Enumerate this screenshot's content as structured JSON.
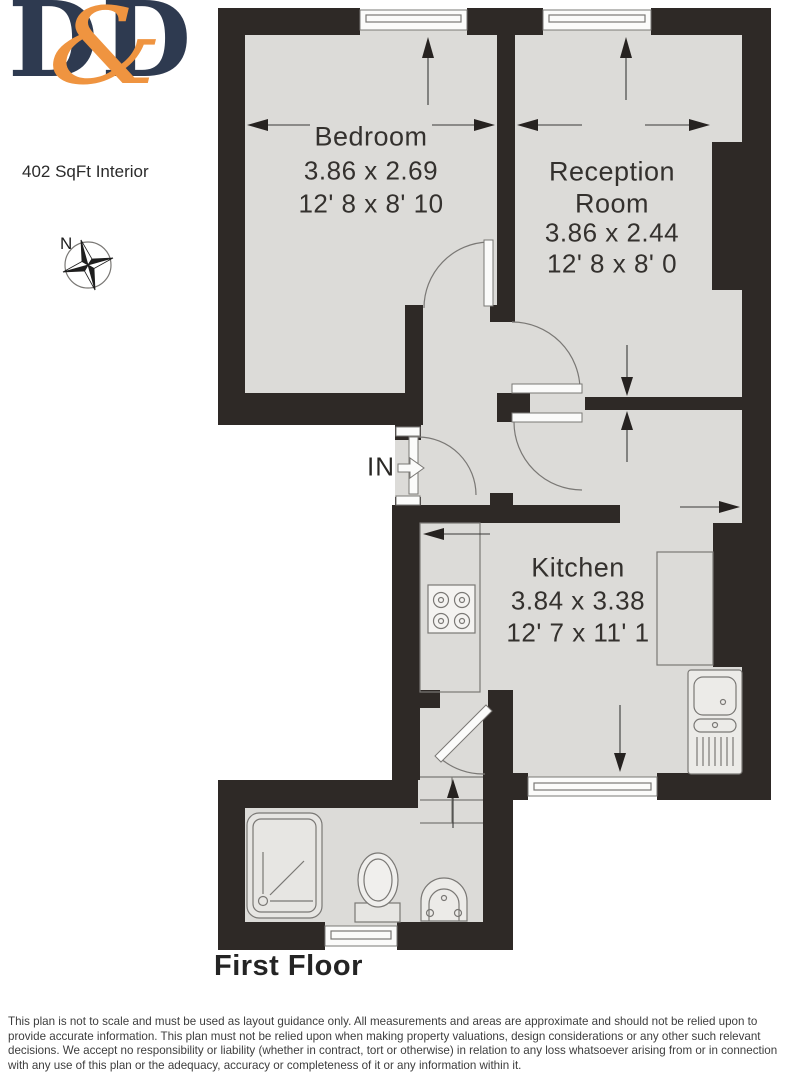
{
  "branding": {
    "logo_d1": "D",
    "logo_amp": "&",
    "logo_d2": "D"
  },
  "area_label": "402 SqFt Interior",
  "compass_label": "N",
  "entrance": {
    "label": "IN"
  },
  "rooms": {
    "bedroom": {
      "name": "Bedroom",
      "metric": "3.86 x 2.69",
      "imperial": "12' 8 x 8' 10"
    },
    "reception": {
      "name_line1": "Reception",
      "name_line2": "Room",
      "metric": "3.86 x 2.44",
      "imperial": "12' 8 x 8' 0"
    },
    "kitchen": {
      "name": "Kitchen",
      "metric": "3.84 x 3.38",
      "imperial": "12' 7 x 11' 1"
    }
  },
  "floor_title": "First Floor",
  "disclaimer": "This plan is not to scale and must be used as layout guidance only. All measurements and areas are approximate and should not be relied upon to provide accurate information. This plan must not be relied upon when making property valuations, design considerations or any other such relevant decisions. We accept no responsibility or liability (whether in contract, tort or otherwise) in relation to any loss whatsoever arising from or in connection with any use of this plan or the adequacy, accuracy or completeness of it or any information within it.",
  "colors": {
    "wall": "#2e2926",
    "floor": "#dcdbd8",
    "line": "#7a7875",
    "logo_navy": "#2e3a50",
    "logo_orange": "#ef9440"
  }
}
